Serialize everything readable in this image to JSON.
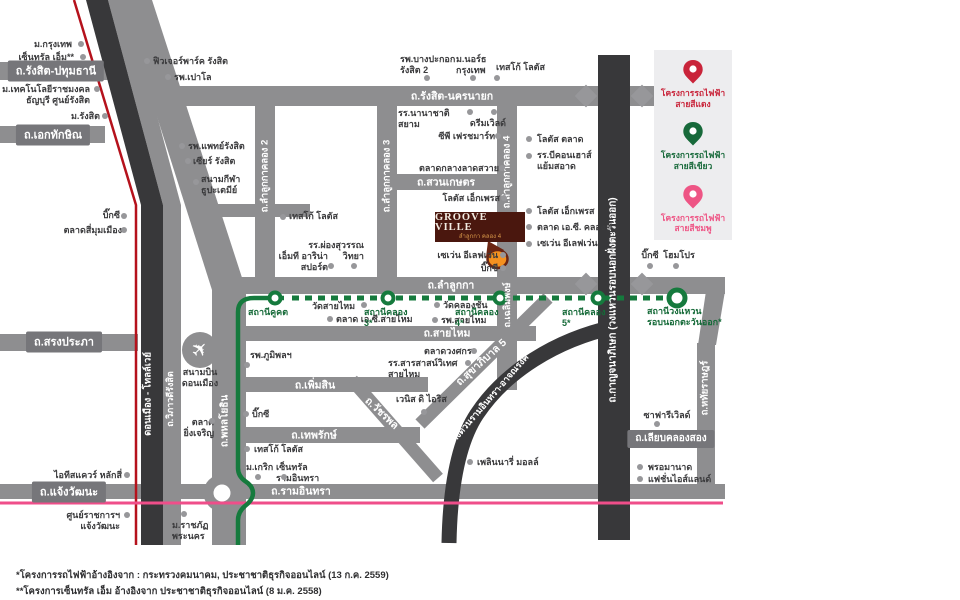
{
  "legend": {
    "items": [
      {
        "id": "red-line-project",
        "label": "โครงการรถไฟฟ้า\nสายสีแดง",
        "color": "#c9243a"
      },
      {
        "id": "green-line-project",
        "label": "โครงการรถไฟฟ้า\nสายสีเขียว",
        "color": "#17693a"
      },
      {
        "id": "pink-line-project",
        "label": "โครงการรถไฟฟ้า\nสายสีชมพู",
        "color": "#ee5585"
      }
    ]
  },
  "logo": {
    "title": "GROOVE VILLE",
    "subtitle": "ลำลูกกา คลอง 4",
    "marker_color": "#f59120"
  },
  "colors": {
    "road": "#8e8e90",
    "dark_road": "#38383a",
    "red_line": "#b5121c",
    "pink_line": "#ef4e8a",
    "green_line": "#157a3d"
  },
  "road_labels": [
    {
      "t": "ถ.รังสิต-ปทุมธานี",
      "x": 56,
      "y": 71,
      "rot": 0,
      "box": true
    },
    {
      "t": "ถ.เอกทักษิณ",
      "x": 53,
      "y": 135,
      "rot": 0,
      "box": true
    },
    {
      "t": "ถ.รังสิต-นครนายก",
      "x": 452,
      "y": 96,
      "rot": 0,
      "box": false
    },
    {
      "t": "ถ.สวนเกษตร",
      "x": 446,
      "y": 182,
      "rot": 0,
      "box": false
    },
    {
      "t": "ถ.ลำลูกกา",
      "x": 451,
      "y": 285,
      "rot": 0,
      "box": false
    },
    {
      "t": "ถ.สายไหม",
      "x": 447,
      "y": 333,
      "rot": 0,
      "box": false
    },
    {
      "t": "ถ.เพิ่มสิน",
      "x": 315,
      "y": 385,
      "rot": 0,
      "box": false
    },
    {
      "t": "ถ.เทพรักษ์",
      "x": 314,
      "y": 435,
      "rot": 0,
      "box": false
    },
    {
      "t": "ถ.สรงประภา",
      "x": 64,
      "y": 342,
      "rot": 0,
      "box": true
    },
    {
      "t": "ถ.แจ้งวัฒนะ",
      "x": 69,
      "y": 492,
      "rot": 0,
      "box": true
    },
    {
      "t": "ถ.รามอินทรา",
      "x": 301,
      "y": 491,
      "rot": 0,
      "box": false
    },
    {
      "t": "ถ.เลียบคลองสอง",
      "x": 671,
      "y": 439,
      "rot": 0,
      "box": true,
      "fs": 10
    },
    {
      "t": "ถ.วัชรพล",
      "x": 382,
      "y": 413,
      "rot": 43,
      "box": false
    },
    {
      "t": "ถ.สุขาภิบาล 5",
      "x": 481,
      "y": 362,
      "rot": -42,
      "box": false
    },
    {
      "t": "ทางด่วนรามอินทรา-อาจณรงค์",
      "x": 488,
      "y": 400,
      "rot": -49,
      "box": false,
      "fs": 9
    },
    {
      "t": "ถ.กาญจนาภิเษก (วงแหวนรอบนอกฝั่งตะวันออก)",
      "x": 613,
      "y": 300,
      "rot": -90,
      "box": false,
      "fs": 10
    },
    {
      "t": "ถ.หทัยราษฎร์",
      "x": 705,
      "y": 388,
      "rot": -90,
      "box": false,
      "fs": 9.5
    },
    {
      "t": "ถ.ลำลูกกาคลอง 2",
      "x": 265,
      "y": 176,
      "rot": -90,
      "box": false,
      "fs": 9.5
    },
    {
      "t": "ถ.ลำลูกกาคลอง 3",
      "x": 387,
      "y": 176,
      "rot": -90,
      "box": false,
      "fs": 9.5
    },
    {
      "t": "ถ.ลำลูกกาคลอง 4",
      "x": 507,
      "y": 172,
      "rot": -90,
      "box": false,
      "fs": 9.5
    },
    {
      "t": "ถ.เฉลิมพงษ์",
      "x": 507,
      "y": 305,
      "rot": -90,
      "box": false,
      "fs": 9
    },
    {
      "t": "ถ.พหลโยธิน",
      "x": 225,
      "y": 421,
      "rot": -90,
      "box": false,
      "fs": 10
    },
    {
      "t": "ดอนเมือง - โทลล์เวย์",
      "x": 148,
      "y": 394,
      "rot": -90,
      "box": false,
      "fs": 9.5
    },
    {
      "t": "ถ.วิภาวดีรังสิต",
      "x": 170,
      "y": 399,
      "rot": -90,
      "box": false,
      "fs": 9
    }
  ],
  "pois": [
    {
      "t": "ม.กรุงเทพ",
      "x": 10,
      "y": 39,
      "w": 62,
      "a": "r",
      "dx": 81,
      "dy": 44
    },
    {
      "t": "เซ็นทรัล เอ็ม**",
      "x": 2,
      "y": 52,
      "w": 72,
      "a": "r",
      "dx": 83,
      "dy": 57
    },
    {
      "t": "ฟิวเจอร์พาร์ค รังสิต",
      "x": 153,
      "y": 56,
      "w": 92,
      "a": "l",
      "dx": 147,
      "dy": 61
    },
    {
      "t": "รพ.เปาโล",
      "x": 174,
      "y": 72,
      "w": 60,
      "a": "l",
      "dx": 168,
      "dy": 77
    },
    {
      "t": "ม.เทคโนโลยีราชมงคล\nธัญบุรี ศูนย์รังสิต",
      "x": 2,
      "y": 84,
      "w": 88,
      "a": "r",
      "dx": 97,
      "dy": 89
    },
    {
      "t": "ม.รังสิต",
      "x": 55,
      "y": 111,
      "w": 45,
      "a": "r",
      "dx": 105,
      "dy": 116
    },
    {
      "t": "รพ.แพทย์รังสิต",
      "x": 188,
      "y": 141,
      "w": 82,
      "a": "l",
      "dx": 182,
      "dy": 146
    },
    {
      "t": "เซียร์ รังสิต",
      "x": 193,
      "y": 156,
      "w": 70,
      "a": "l",
      "dx": 188,
      "dy": 161
    },
    {
      "t": "สนามกีฬา\nธูปะเตมีย์",
      "x": 201,
      "y": 174,
      "w": 60,
      "a": "l",
      "dx": 196,
      "dy": 182
    },
    {
      "t": "รพ.บางปะกอก\nรังสิต 2",
      "x": 400,
      "y": 54,
      "w": 58,
      "a": "l",
      "dx": 427,
      "dy": 78
    },
    {
      "t": "ม.นอร์ธ\nกรุงเทพ",
      "x": 456,
      "y": 54,
      "w": 44,
      "a": "l",
      "dx": 473,
      "dy": 78
    },
    {
      "t": "เทสโก้ โลตัส",
      "x": 496,
      "y": 62,
      "w": 62,
      "a": "l",
      "dx": 497,
      "dy": 78
    },
    {
      "t": "บิ๊กซี",
      "x": 88,
      "y": 210,
      "w": 32,
      "a": "r",
      "dx": 124,
      "dy": 216
    },
    {
      "t": "ตลาดสี่มุมเมือง",
      "x": 52,
      "y": 225,
      "w": 70,
      "a": "r",
      "dx": 124,
      "dy": 230
    },
    {
      "t": "เทสโก้ โลตัส",
      "x": 289,
      "y": 211,
      "w": 62,
      "a": "l",
      "dx": 283,
      "dy": 217
    },
    {
      "t": "รร.ผ่องสุวรรณ\nวิทยา",
      "x": 302,
      "y": 240,
      "w": 62,
      "a": "r",
      "dx": 354,
      "dy": 266
    },
    {
      "t": "เอ็มที อาริน่า\nสปอร์ต",
      "x": 270,
      "y": 251,
      "w": 58,
      "a": "r",
      "dx": 331,
      "dy": 266
    },
    {
      "t": "โลตัส เอ็กเพรส",
      "x": 440,
      "y": 193,
      "w": 60,
      "a": "r",
      "dx": 504,
      "dy": 198
    },
    {
      "t": "ตลาดกลางลาดสวาย",
      "x": 405,
      "y": 163,
      "w": 94,
      "a": "r",
      "dx": 502,
      "dy": 168
    },
    {
      "t": "ซีพี เฟรชมาร์ท",
      "x": 425,
      "y": 131,
      "w": 70,
      "a": "r",
      "dx": 498,
      "dy": 136
    },
    {
      "t": "ดรีมเวิลด์",
      "x": 460,
      "y": 118,
      "w": 46,
      "a": "r",
      "dx": 494,
      "dy": 112
    },
    {
      "t": "รร.นานาชาติสยาม",
      "x": 398,
      "y": 108,
      "w": 66,
      "a": "l",
      "dx": 470,
      "dy": 112
    },
    {
      "t": "โลตัส ตลาด",
      "x": 537,
      "y": 134,
      "w": 55,
      "a": "l",
      "dx": 529,
      "dy": 139
    },
    {
      "t": "รร.บีคอนเฮาส์\nแย้มสอาด",
      "x": 537,
      "y": 150,
      "w": 64,
      "a": "l",
      "dx": 529,
      "dy": 156
    },
    {
      "t": "โลตัส เอ็กเพรส",
      "x": 537,
      "y": 206,
      "w": 64,
      "a": "l",
      "dx": 529,
      "dy": 211
    },
    {
      "t": "ตลาด เอ.ซี. คลอง 4",
      "x": 537,
      "y": 222,
      "w": 78,
      "a": "l",
      "dx": 529,
      "dy": 227
    },
    {
      "t": "เซเว่น อีเลฟเว่น",
      "x": 537,
      "y": 238,
      "w": 70,
      "a": "l",
      "dx": 529,
      "dy": 244
    },
    {
      "t": "เซเว่น อีเลฟเว่น",
      "x": 434,
      "y": 250,
      "w": 64,
      "a": "r",
      "dx": 503,
      "dy": 255
    },
    {
      "t": "บิ๊กซี",
      "x": 464,
      "y": 263,
      "w": 34,
      "a": "r",
      "dx": 503,
      "dy": 268
    },
    {
      "t": "บิ๊กซี",
      "x": 637,
      "y": 250,
      "w": 26,
      "a": "c",
      "dx": 650,
      "dy": 266
    },
    {
      "t": "โฮมโปร",
      "x": 658,
      "y": 250,
      "w": 42,
      "a": "c",
      "dx": 676,
      "dy": 266
    },
    {
      "t": "วัดสายไหม",
      "x": 312,
      "y": 301,
      "w": 50,
      "a": "l",
      "dx": 364,
      "dy": 305
    },
    {
      "t": "ตลาด เอ.ซี.สายไหม",
      "x": 336,
      "y": 314,
      "w": 82,
      "a": "l",
      "dx": 330,
      "dy": 319
    },
    {
      "t": "วัดคลองชัน",
      "x": 443,
      "y": 300,
      "w": 52,
      "a": "l",
      "dx": 437,
      "dy": 305
    },
    {
      "t": "รพ.สายไหม",
      "x": 441,
      "y": 315,
      "w": 54,
      "a": "l",
      "dx": 435,
      "dy": 320
    },
    {
      "t": "รพ.ภูมิพลฯ",
      "x": 250,
      "y": 350,
      "w": 55,
      "a": "l",
      "dx": 247,
      "dy": 365
    },
    {
      "t": "ตลาดวงศกร",
      "x": 424,
      "y": 346,
      "w": 50,
      "a": "l",
      "dx": 474,
      "dy": 351
    },
    {
      "t": "รร.สารสาสน์วิเทศ สายไหม",
      "x": 388,
      "y": 358,
      "w": 78,
      "a": "l",
      "dx": 468,
      "dy": 363
    },
    {
      "t": "เวนิส ดิ ไอริส",
      "x": 396,
      "y": 394,
      "w": 52,
      "a": "l",
      "dx": 424,
      "dy": 412
    },
    {
      "t": "ตลาด\nยิ่งเจริญ",
      "x": 178,
      "y": 417,
      "w": 36,
      "a": "r",
      "dx": 212,
      "dy": 421
    },
    {
      "t": "บิ๊กซี",
      "x": 252,
      "y": 409,
      "w": 30,
      "a": "l",
      "dx": 246,
      "dy": 414
    },
    {
      "t": "เทสโก้ โลตัส",
      "x": 254,
      "y": 444,
      "w": 62,
      "a": "l",
      "dx": 247,
      "dy": 449
    },
    {
      "t": "ม.เกริก",
      "x": 246,
      "y": 462,
      "w": 36,
      "a": "l",
      "dx": 258,
      "dy": 477
    },
    {
      "t": "เซ็นทรัล รามอินทรา",
      "x": 276,
      "y": 462,
      "w": 74,
      "a": "l",
      "dx": 284,
      "dy": 477
    },
    {
      "t": "เพลินนารี่ มอลล์",
      "x": 477,
      "y": 457,
      "w": 64,
      "a": "l",
      "dx": 470,
      "dy": 462
    },
    {
      "t": "ไอทีสแควร์ หลักสี่",
      "x": 52,
      "y": 470,
      "w": 70,
      "a": "r",
      "dx": 127,
      "dy": 475
    },
    {
      "t": "ศูนย์ราชการฯ แจ้งวัฒนะ",
      "x": 32,
      "y": 510,
      "w": 88,
      "a": "r",
      "dx": 127,
      "dy": 515
    },
    {
      "t": "ม.ราชภัฏ\nพระนคร",
      "x": 172,
      "y": 520,
      "w": 42,
      "a": "l",
      "dx": 184,
      "dy": 514
    },
    {
      "t": "ซาฟารีเวิลด์",
      "x": 638,
      "y": 410,
      "w": 58,
      "a": "c",
      "dx": 657,
      "dy": 424
    },
    {
      "t": "พรอมานาด",
      "x": 648,
      "y": 462,
      "w": 54,
      "a": "l",
      "dx": 640,
      "dy": 467
    },
    {
      "t": "แฟชั่นไอส์แลนด์",
      "x": 648,
      "y": 474,
      "w": 68,
      "a": "l",
      "dx": 640,
      "dy": 479
    },
    {
      "t": "สนามบิน\nดอนเมือง",
      "x": 172,
      "y": 367,
      "w": 56,
      "a": "c"
    },
    {
      "t": "สถานีคูคต",
      "x": 248,
      "y": 307,
      "w": 46,
      "a": "l",
      "cls": "station"
    },
    {
      "t": "สถานีคลอง 3*",
      "x": 364,
      "y": 307,
      "w": 54,
      "a": "l",
      "cls": "station"
    },
    {
      "t": "สถานีคลอง 4*",
      "x": 455,
      "y": 307,
      "w": 54,
      "a": "l",
      "cls": "station"
    },
    {
      "t": "สถานีคลอง 5*",
      "x": 562,
      "y": 307,
      "w": 54,
      "a": "l",
      "cls": "station"
    },
    {
      "t": "สถานีวงแหวน\nรอบนอกตะวันออก*",
      "x": 647,
      "y": 306,
      "w": 76,
      "a": "l",
      "cls": "station"
    }
  ],
  "footnotes": [
    "*โครงการรถไฟฟ้าอ้างอิงจาก : กระทรวงคมนาคม, ประชาชาติธุรกิจออนไลน์ (13 ก.ค. 2559)",
    "**โครงการเซ็นทรัล เอ็ม อ้างอิงจาก ประชาชาติธุรกิจออนไลน์ (8 ม.ค. 2558)"
  ]
}
